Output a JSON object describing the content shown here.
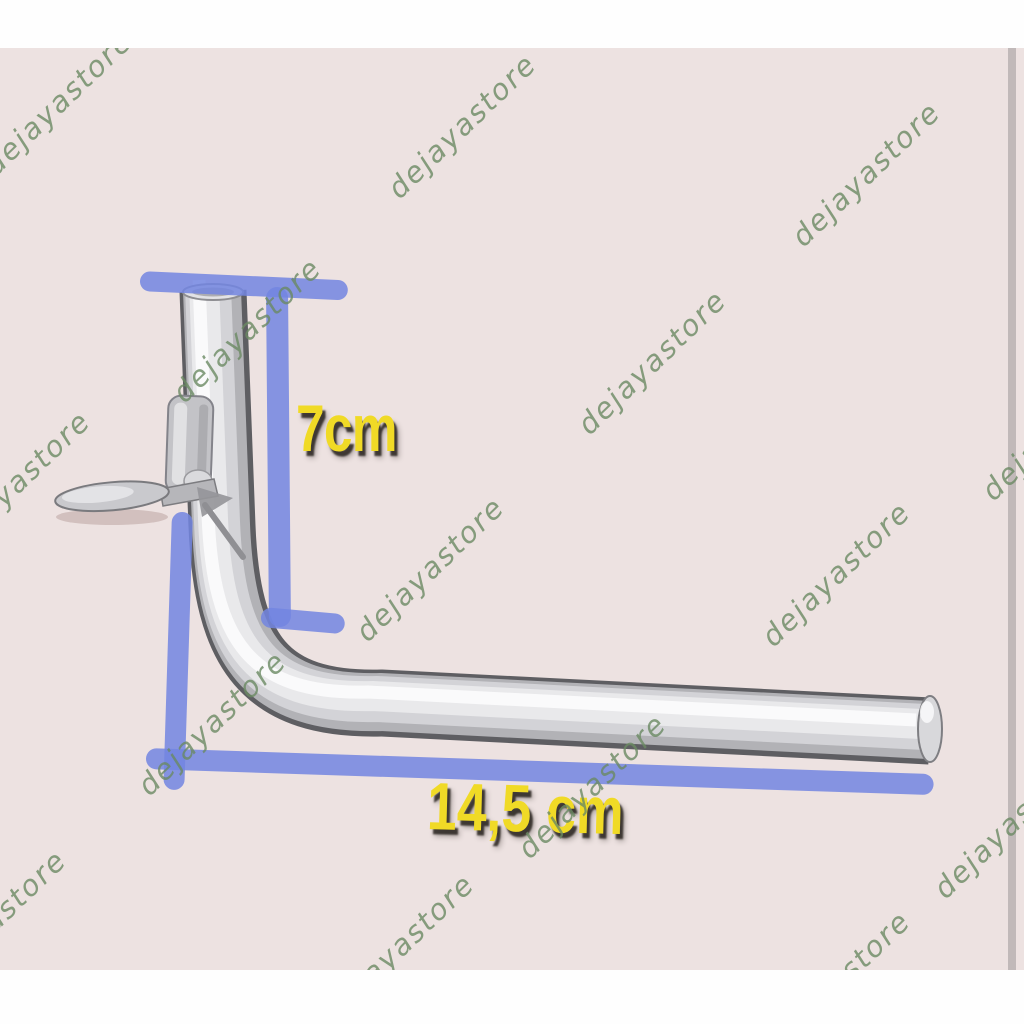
{
  "page_type": "e-commerce product photo",
  "product": {
    "description": "L-shaped chrome metal pipe (antenna bracket arm) with mounting clip"
  },
  "annotations": {
    "vertical_dimension": "7cm",
    "horizontal_dimension": "14,5 cm"
  },
  "watermark": {
    "text": "dejayastore",
    "count": 15,
    "color": "#6A8A63"
  },
  "colors": {
    "photo_background": "#EDE2E1",
    "letterbox_bars": "#FFFFFF",
    "dimension_line_blue": "#7285E0",
    "dimension_text_yellow": "#F0DA26",
    "pipe_metal_gray": "#C9C9CD"
  }
}
